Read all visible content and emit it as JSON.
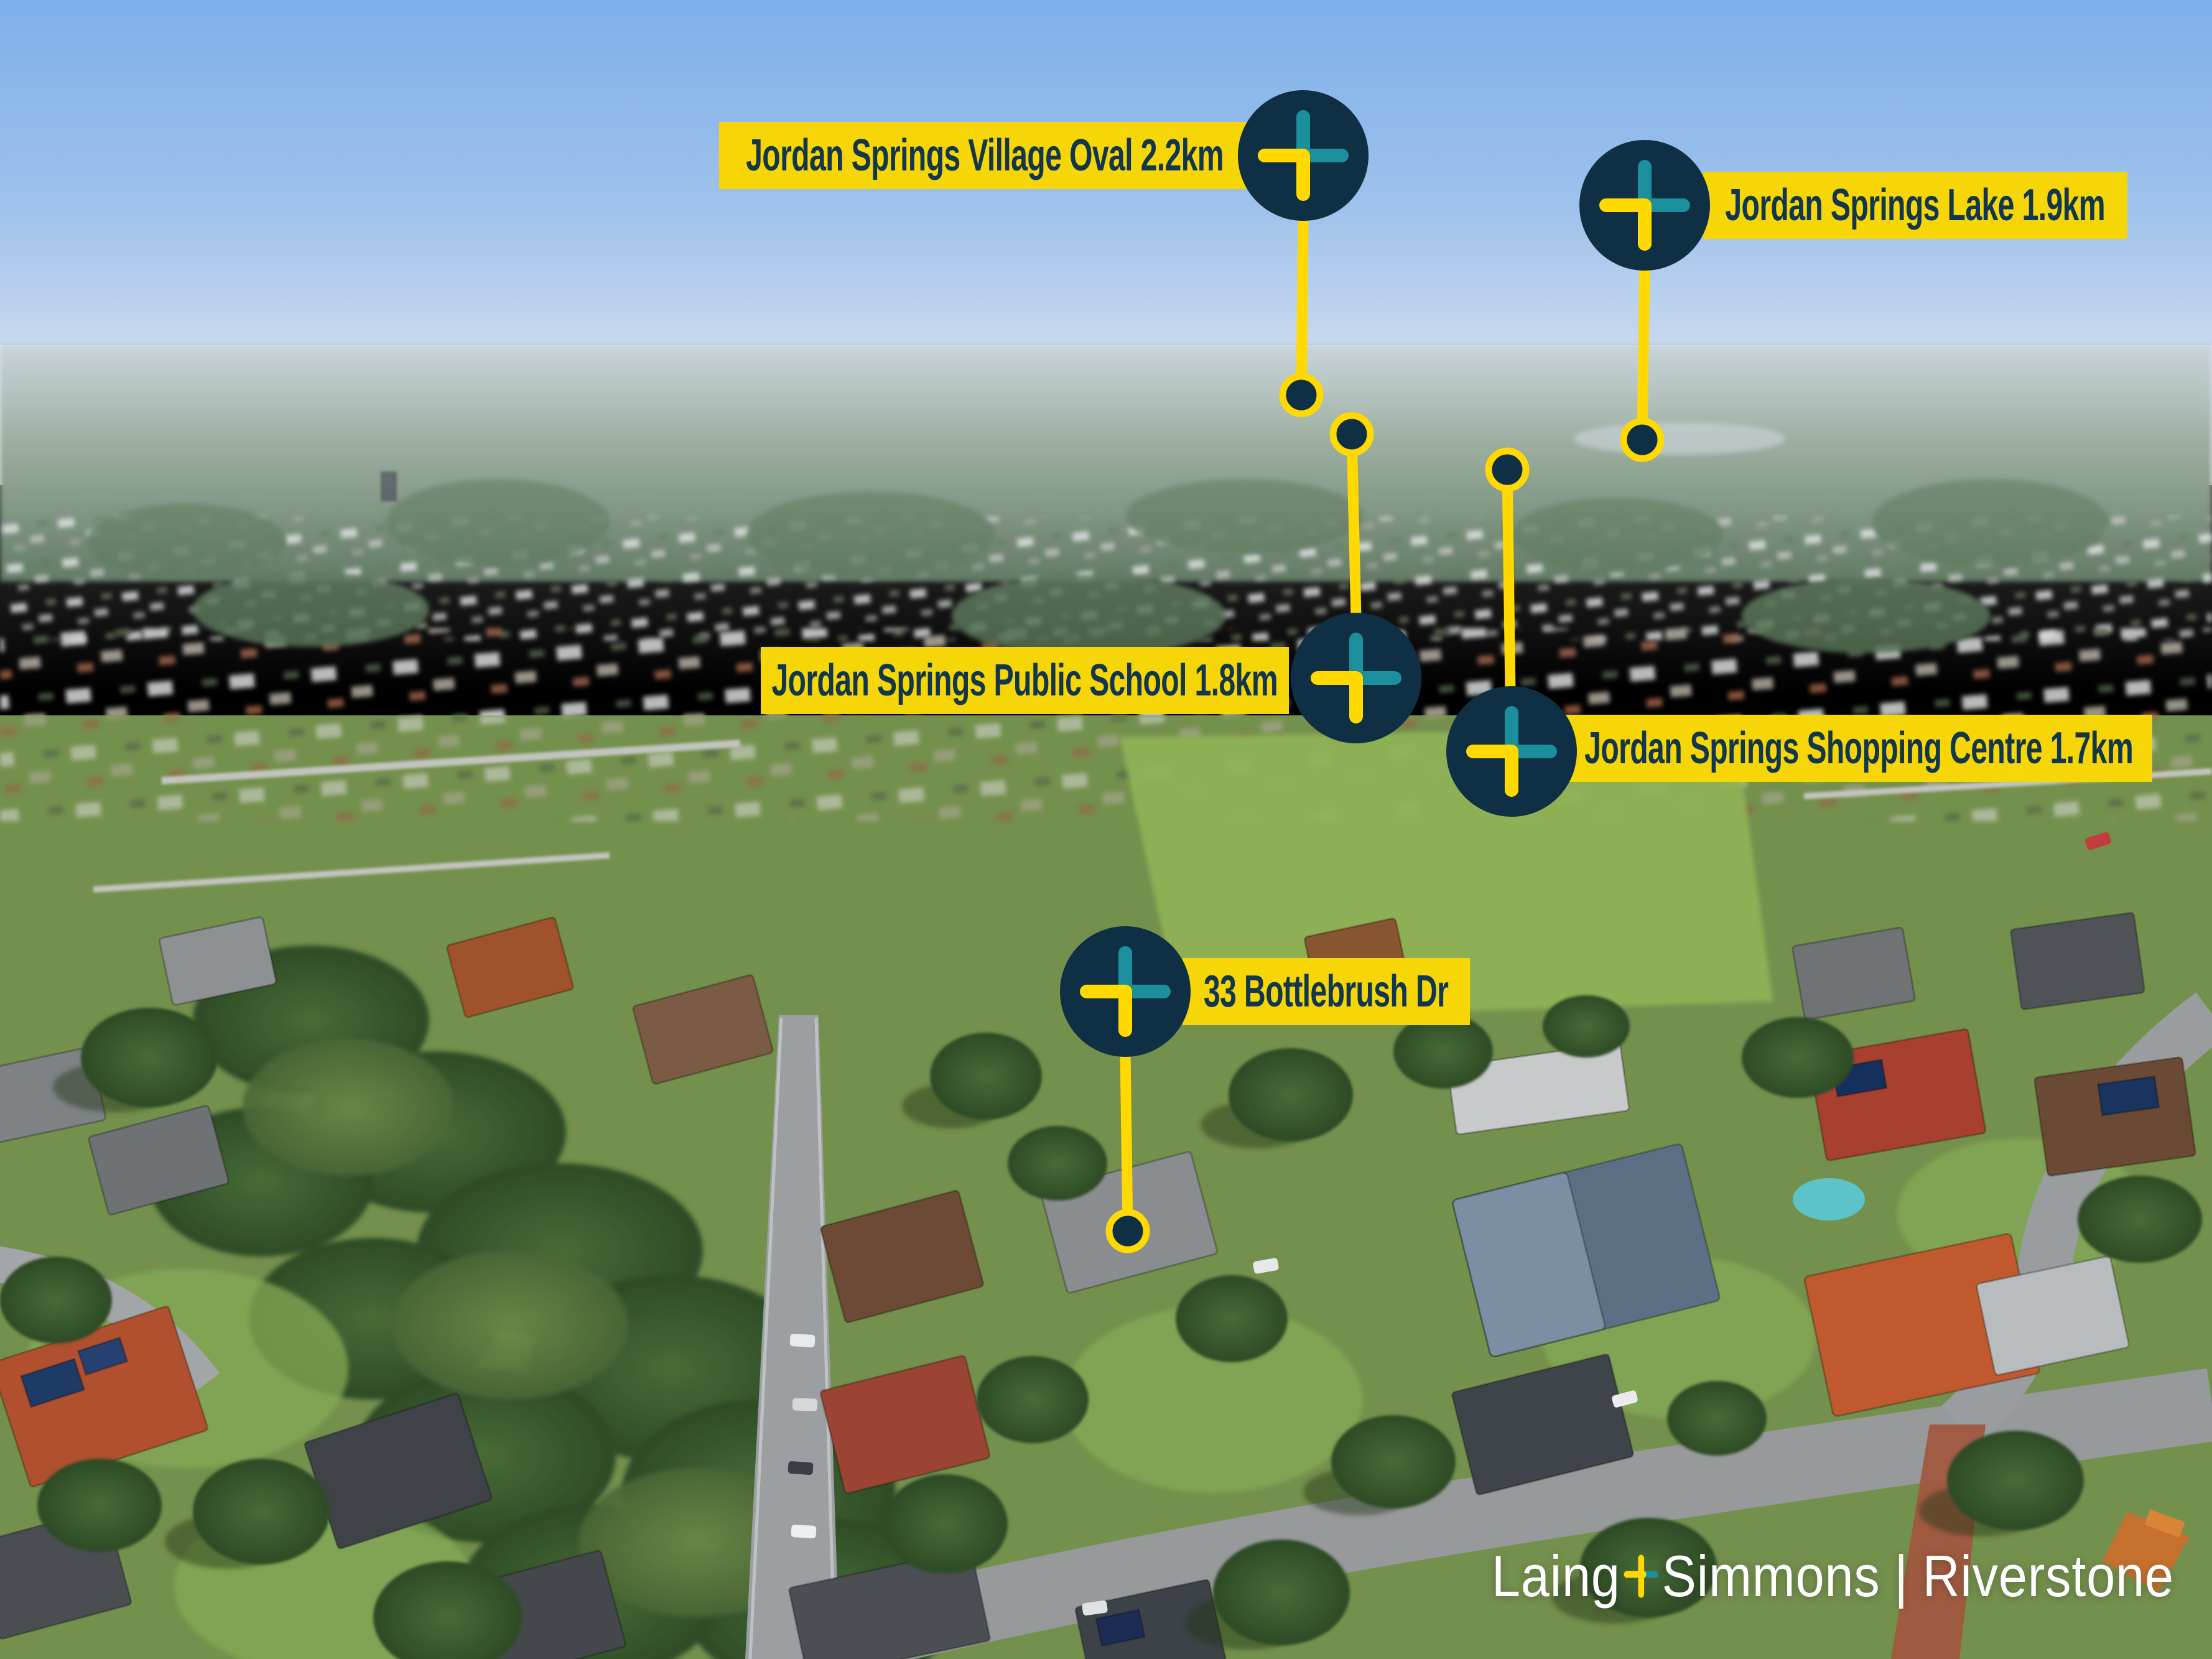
{
  "image": {
    "type": "aerial-drone-photograph",
    "scene": "suburban neighbourhood with real-estate location markers"
  },
  "colors": {
    "accent_yellow": "#F6D607",
    "line_yellow": "#FFD900",
    "badge_navy": "#0F3044",
    "teal": "#1B8F9B",
    "label_text_navy": "#11364D",
    "logo_white": "#FFFFFF"
  },
  "markers": [
    {
      "name": "village-oval",
      "label": "Jordan Springs Village Oval 2.2km"
    },
    {
      "name": "lake",
      "label": "Jordan Springs Lake 1.9km"
    },
    {
      "name": "public-school",
      "label": "Jordan Springs Public School 1.8km"
    },
    {
      "name": "shopping-centre",
      "label": "Jordan Springs Shopping Centre 1.7km"
    },
    {
      "name": "property",
      "label": "33 Bottlebrush Dr"
    }
  ],
  "logo": {
    "brand_left": "Laing",
    "brand_right": "Simmons",
    "separator": "|",
    "office": "Riverstone"
  }
}
